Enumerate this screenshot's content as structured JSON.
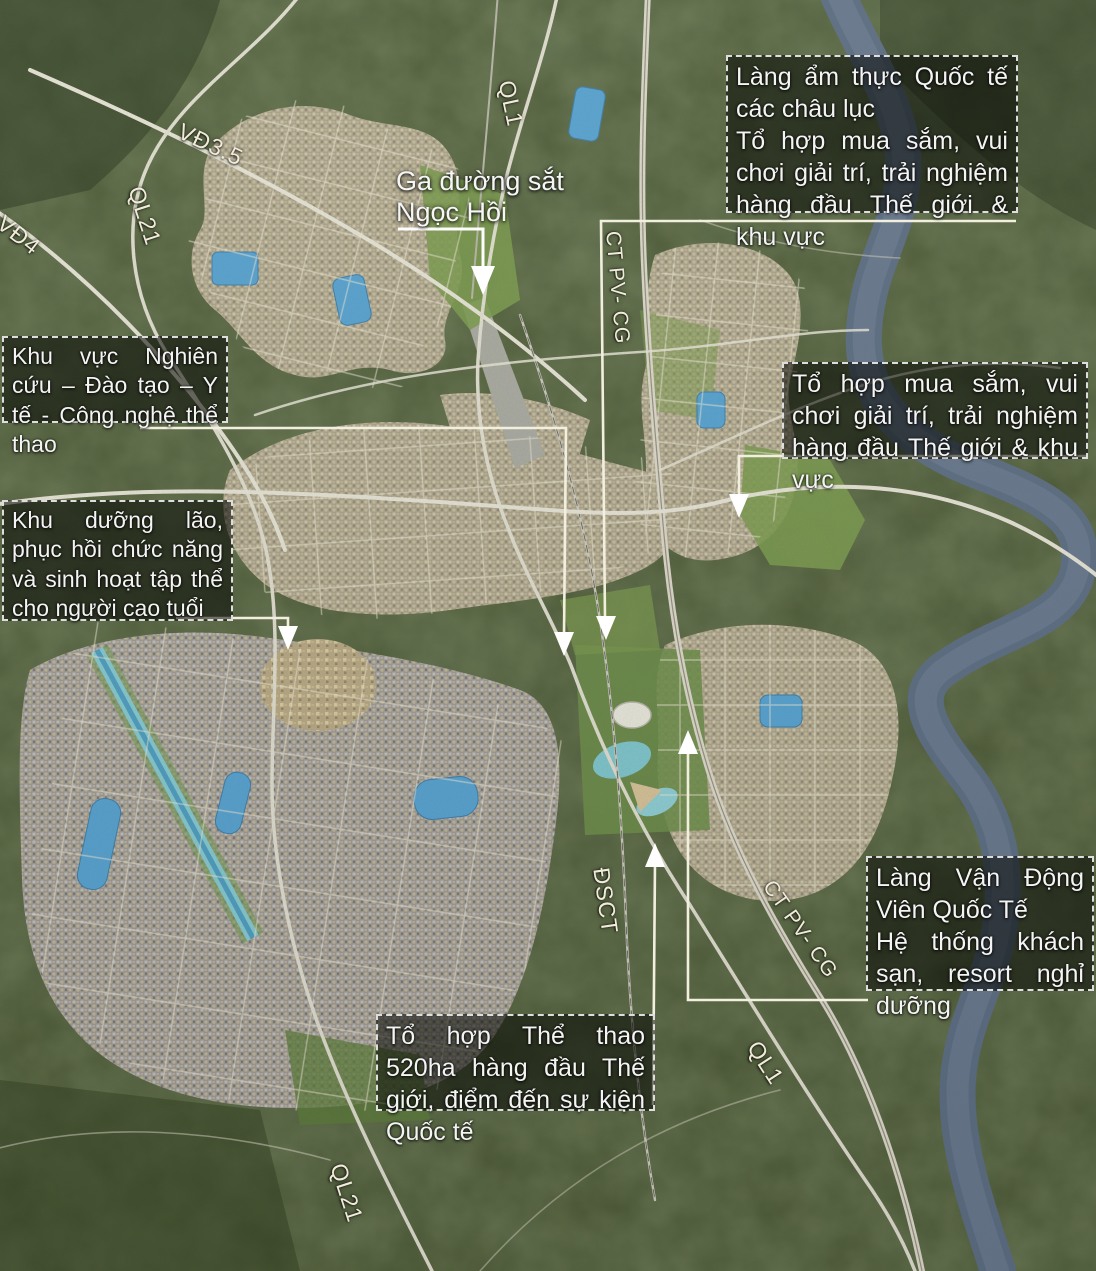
{
  "map_type": "urban-planning-satellite-map",
  "callouts": [
    {
      "id": "food-village",
      "lines": [
        "Làng ẩm thực Quốc tế các châu lục",
        "Tổ hợp mua sắm, vui chơi giải trí, trải nghiệm hàng đầu Thế giới & khu vực"
      ]
    },
    {
      "id": "research-zone",
      "lines": [
        "Khu vực Nghiên cứu – Đào tạo – Y tế - Công nghệ thể thao"
      ]
    },
    {
      "id": "elderly-zone",
      "lines": [
        "Khu dưỡng lão, phục hồi chức năng và sinh hoạt tập thể cho người cao tuổi"
      ]
    },
    {
      "id": "shopping-complex",
      "lines": [
        "Tổ hợp mua sắm, vui chơi giải trí, trải nghiệm hàng đầu Thế giới & khu vực"
      ]
    },
    {
      "id": "athletes-village",
      "lines": [
        "Làng Vận Động Viên Quốc Tế",
        "Hệ thống khách sạn, resort nghỉ dưỡng"
      ]
    },
    {
      "id": "sports-complex",
      "lines": [
        "Tổ hợp Thể thao 520ha hàng đầu Thế giới, điểm đến sự kiện Quốc tế"
      ]
    }
  ],
  "station_label": {
    "lines": [
      "Ga đường sắt",
      "Ngọc Hồi"
    ]
  },
  "road_labels": [
    {
      "id": "vd3-5",
      "text": "VĐ3.5"
    },
    {
      "id": "vd4",
      "text": "VĐ4"
    },
    {
      "id": "ql21-north",
      "text": "QL21"
    },
    {
      "id": "ql1-north",
      "text": "QL1"
    },
    {
      "id": "ct-pv-cg-north",
      "text": "CT PV- CG"
    },
    {
      "id": "dsct",
      "text": "ĐSCT"
    },
    {
      "id": "ct-pv-cg-south",
      "text": "CT PV- CG"
    },
    {
      "id": "ql1-south",
      "text": "QL1"
    },
    {
      "id": "ql21-south",
      "text": "QL21"
    }
  ],
  "colors": {
    "vegetation": "#44512e",
    "vegetation_dark": "#2c381f",
    "river": "#5d6e85",
    "lake": "#57a4d4",
    "canal": "#86ccd4",
    "urban_tan": "#b2a890",
    "park_green": "#7d9c4f",
    "road": "#e9e6d8",
    "annotation_text": "#f4f4f4",
    "leader_line": "#f2efdf"
  }
}
